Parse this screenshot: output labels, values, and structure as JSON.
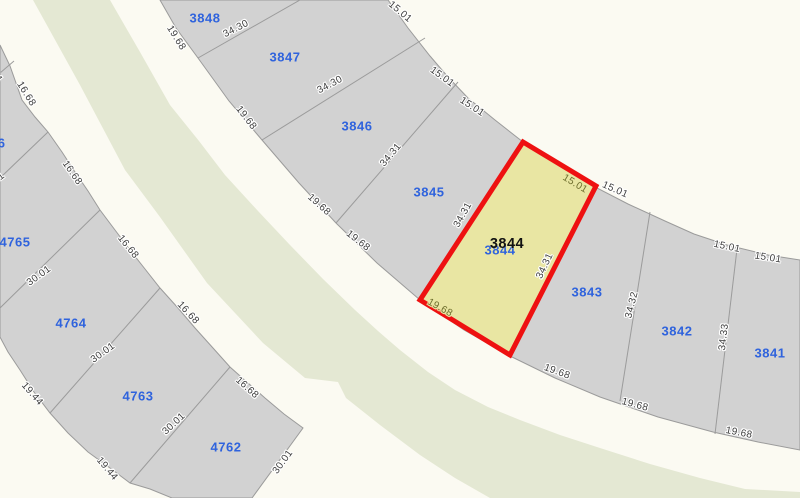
{
  "map": {
    "type": "cadastral-parcel-map",
    "selected_parcel": {
      "id": "3844",
      "front_dimension": "19.68",
      "rear_dimension": "15.01",
      "side_dimension": "34.31"
    },
    "colors": {
      "street": "#fbfaf2",
      "median_green": "#e4e8d3",
      "parcel_fill": "#d2d2d2",
      "parcel_line": "#9b9b9b",
      "selected_fill": "#e9e6a3",
      "selected_outline": "#ee1111",
      "parcel_number_blue": "#2f63dd",
      "dimension_text": "#3d3d3d",
      "olive_text": "#6e6e2e"
    },
    "parcel_labels": [
      {
        "text": "3848",
        "x": 205,
        "y": 18
      },
      {
        "text": "3847",
        "x": 285,
        "y": 57
      },
      {
        "text": "3846",
        "x": 357,
        "y": 126
      },
      {
        "text": "3845",
        "x": 429,
        "y": 192
      },
      {
        "text": "3844",
        "x": 500,
        "y": 250
      },
      {
        "text": "3843",
        "x": 587,
        "y": 292
      },
      {
        "text": "3842",
        "x": 677,
        "y": 331
      },
      {
        "text": "3841",
        "x": 770,
        "y": 353
      },
      {
        "text": "4766",
        "x": -10,
        "y": 143
      },
      {
        "text": "4765",
        "x": 15,
        "y": 242
      },
      {
        "text": "4764",
        "x": 71,
        "y": 323
      },
      {
        "text": "4763",
        "x": 138,
        "y": 396
      },
      {
        "text": "4762",
        "x": 226,
        "y": 447
      }
    ],
    "selected_label": {
      "text": "3844",
      "x": 507,
      "y": 244
    },
    "dimension_labels": [
      {
        "text": "19.68",
        "x": 176,
        "y": 38,
        "rot": 58
      },
      {
        "text": "19.68",
        "x": 246,
        "y": 118,
        "rot": 52
      },
      {
        "text": "19.68",
        "x": 319,
        "y": 205,
        "rot": 42
      },
      {
        "text": "19.68",
        "x": 358,
        "y": 241,
        "rot": 38
      },
      {
        "text": "19.68",
        "x": 440,
        "y": 308,
        "rot": 29,
        "olive": true
      },
      {
        "text": "19.68",
        "x": 557,
        "y": 372,
        "rot": 20
      },
      {
        "text": "19.68",
        "x": 635,
        "y": 405,
        "rot": 15
      },
      {
        "text": "19.68",
        "x": 739,
        "y": 433,
        "rot": 11
      },
      {
        "text": "15.01",
        "x": 400,
        "y": 12,
        "rot": 40
      },
      {
        "text": "15.01",
        "x": 442,
        "y": 77,
        "rot": 36
      },
      {
        "text": "15.01",
        "x": 472,
        "y": 107,
        "rot": 33
      },
      {
        "text": "15.01",
        "x": 575,
        "y": 184,
        "rot": 31,
        "olive": true
      },
      {
        "text": "15.01",
        "x": 615,
        "y": 190,
        "rot": 24
      },
      {
        "text": "15.01",
        "x": 727,
        "y": 247,
        "rot": 12
      },
      {
        "text": "15.01",
        "x": 768,
        "y": 258,
        "rot": 9
      },
      {
        "text": "34.30",
        "x": 236,
        "y": 29,
        "rot": -27
      },
      {
        "text": "34.30",
        "x": 330,
        "y": 85,
        "rot": -28
      },
      {
        "text": "34.31",
        "x": 391,
        "y": 155,
        "rot": -50
      },
      {
        "text": "34.31",
        "x": 463,
        "y": 215,
        "rot": -61
      },
      {
        "text": "34.31",
        "x": 545,
        "y": 266,
        "rot": -65
      },
      {
        "text": "34.32",
        "x": 632,
        "y": 305,
        "rot": -76
      },
      {
        "text": "34.33",
        "x": 724,
        "y": 337,
        "rot": -83
      },
      {
        "text": "16.68",
        "x": 26,
        "y": 94,
        "rot": 58
      },
      {
        "text": "16.68",
        "x": 72,
        "y": 173,
        "rot": 55
      },
      {
        "text": "16.68",
        "x": 128,
        "y": 247,
        "rot": 51
      },
      {
        "text": "16.68",
        "x": 188,
        "y": 313,
        "rot": 47
      },
      {
        "text": "16.68",
        "x": 247,
        "y": 388,
        "rot": 42
      },
      {
        "text": "30.01",
        "x": -7,
        "y": 183,
        "rot": -38
      },
      {
        "text": "30.01",
        "x": 39,
        "y": 276,
        "rot": -36
      },
      {
        "text": "30.01",
        "x": 103,
        "y": 353,
        "rot": -36
      },
      {
        "text": "30.01",
        "x": 174,
        "y": 424,
        "rot": -43
      },
      {
        "text": "30.01",
        "x": 283,
        "y": 462,
        "rot": -54
      },
      {
        "text": "19.44",
        "x": -8,
        "y": 70,
        "rot": 55
      },
      {
        "text": "19.44",
        "x": 32,
        "y": 394,
        "rot": 49
      },
      {
        "text": "19.44",
        "x": 107,
        "y": 469,
        "rot": 50
      }
    ]
  }
}
